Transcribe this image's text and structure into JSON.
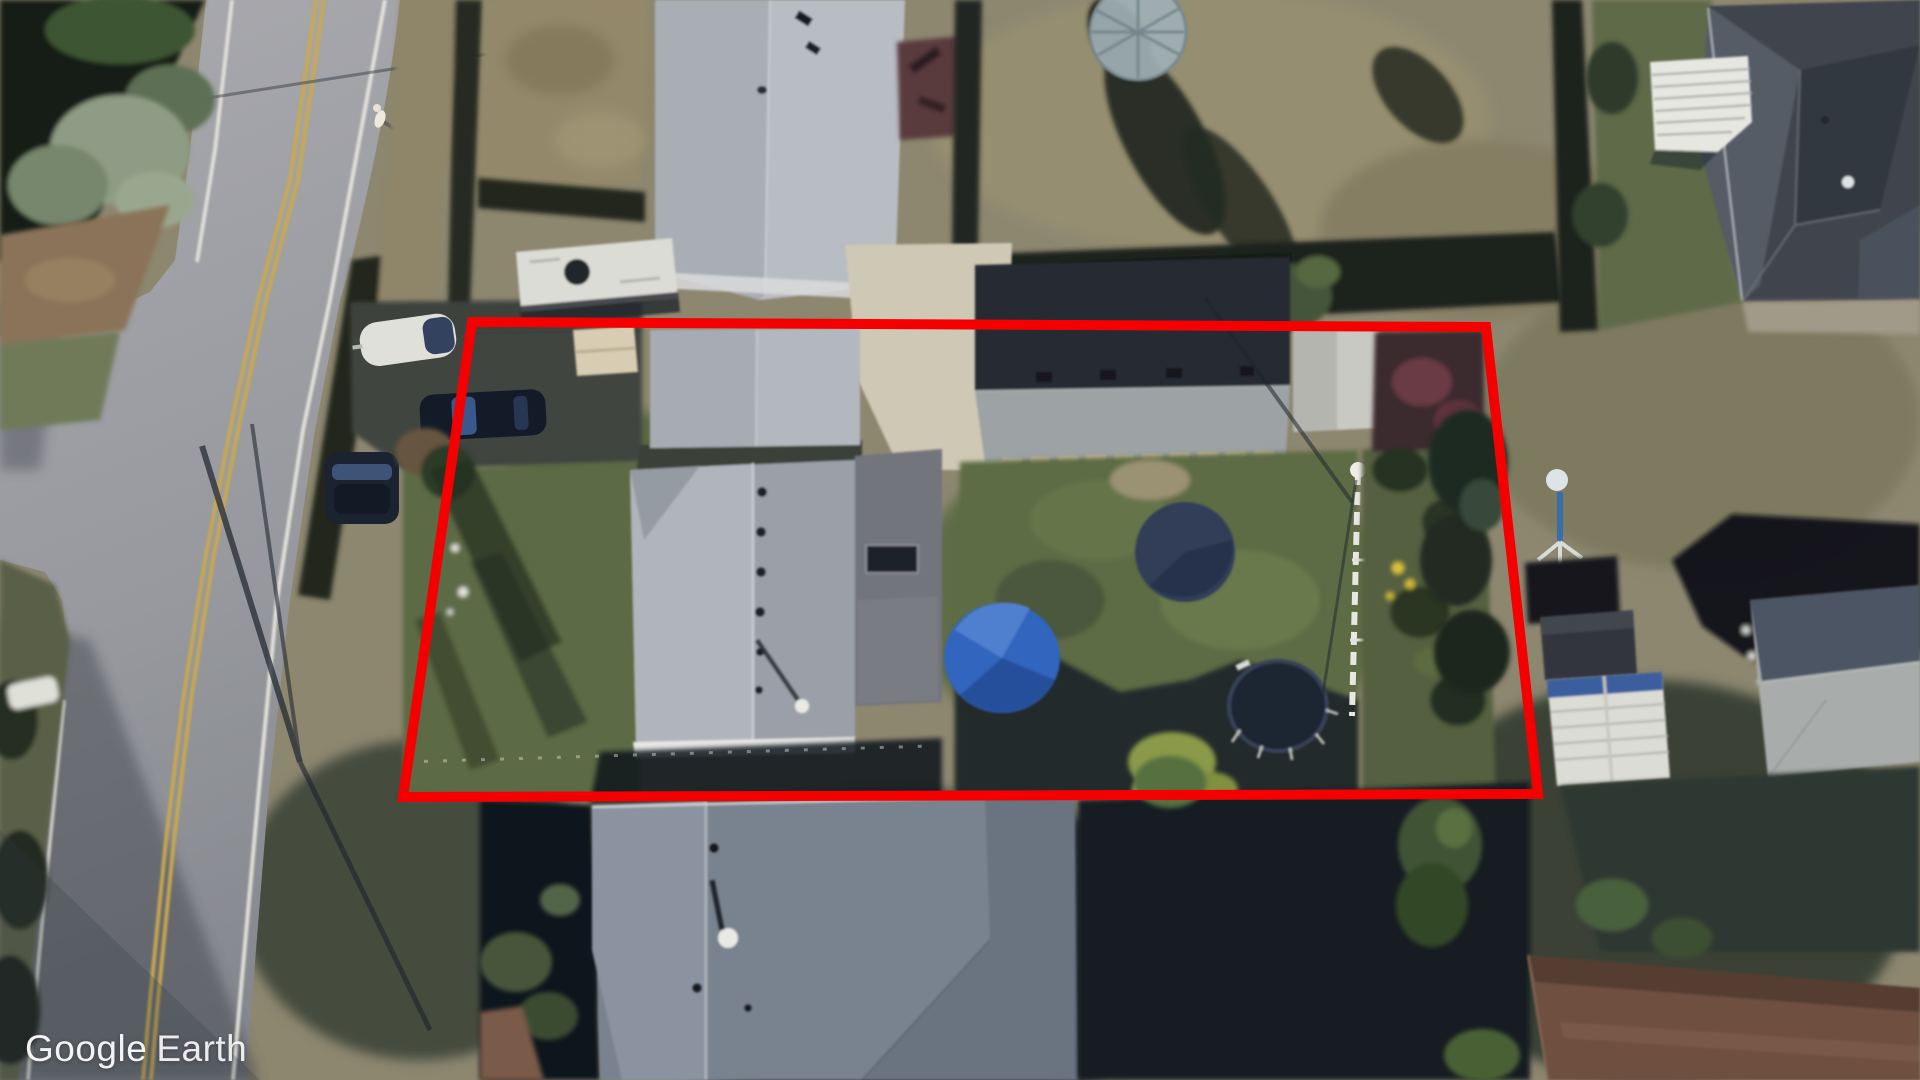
{
  "watermark": {
    "brand": "Google",
    "product": "Earth"
  },
  "annotation": {
    "label": "property-boundary",
    "shape": "quadrilateral",
    "color": "#f50000",
    "stroke_width": 10,
    "points": "472,322 1486,327 1538,794 403,797"
  },
  "scene": {
    "type": "aerial-satellite-view",
    "description": "Oblique aerial view of a residential parcel outlined in red, with a road on the left"
  },
  "palette": {
    "road": "#9b9ba0",
    "road_line_white": "#e9e7df",
    "road_line_yellow": "#c9a94e",
    "dry_grass": "#8d8770",
    "lawn_green": "#5e6d46",
    "roof_light_gray": "#b0b5bb",
    "roof_dark_charcoal": "#3f454e",
    "deep_shadow": "#10161f",
    "pool_dome_blue": "#3065bd",
    "trampoline_dark": "#1f2633",
    "brown_roof": "#6e4f41"
  }
}
